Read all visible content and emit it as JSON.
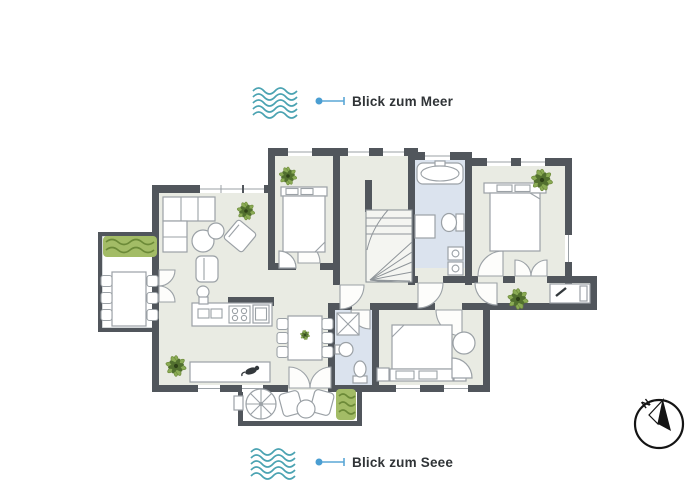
{
  "view_labels": {
    "top": "Blick zum Meer",
    "bottom": "Blick zum Seee"
  },
  "compass": {
    "north": "N"
  },
  "colors": {
    "wall": "#51565c",
    "room_floor": "#e9ebe3",
    "bath_floor": "#dbe3ee",
    "outdoor_floor": "#ffffff",
    "furniture_stroke": "#9ba1a6",
    "wave_teal": "#4ba3b2",
    "indicator_blue": "#5aa7d6",
    "indicator_dot": "#4a9ed2",
    "plant_light_green": "#8aab55",
    "plant_dark_green": "#52702f",
    "hedge_green": "#a3bc66",
    "label_text": "#303437",
    "compass_black": "#141414"
  }
}
